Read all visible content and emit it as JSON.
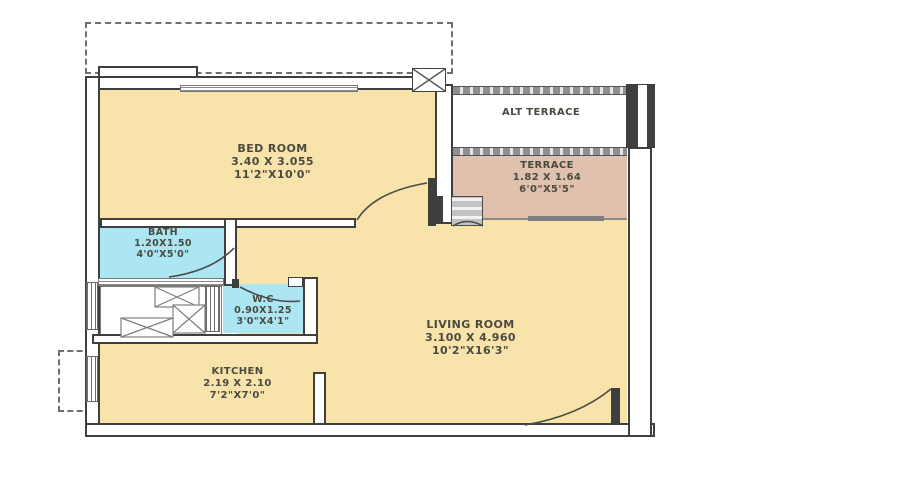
{
  "plan": {
    "type": "residential-floor-plan"
  },
  "rooms": [
    {
      "id": "bedroom",
      "name": "BED ROOM",
      "metric": "3.40 X 3.055",
      "imperial": "11'2\"X10'0\""
    },
    {
      "id": "alt-terrace",
      "name": "ALT TERRACE",
      "metric": "",
      "imperial": ""
    },
    {
      "id": "terrace",
      "name": "TERRACE",
      "metric": "1.82 X 1.64",
      "imperial": "6'0\"X5'5\""
    },
    {
      "id": "bath",
      "name": "BATH",
      "metric": "1.20X1.50",
      "imperial": "4'0\"X5'0\""
    },
    {
      "id": "wc",
      "name": "W.C",
      "metric": "0.90X1.25",
      "imperial": "3'0\"X4'1\""
    },
    {
      "id": "kitchen",
      "name": "KITCHEN",
      "metric": "2.19 X 2.10",
      "imperial": "7'2\"X7'0\""
    },
    {
      "id": "living",
      "name": "LIVING ROOM",
      "metric": "3.100 X 4.960",
      "imperial": "10'2\"X16'3\""
    }
  ],
  "colors": {
    "room_fill": "#f8e3aa",
    "wet_fill": "#abe6f2",
    "terrace_fill": "#e0c1ae",
    "wall_line": "#3f3f3f",
    "hatch_gray": "#a5a5a5",
    "label_color": "#4a4a40"
  }
}
